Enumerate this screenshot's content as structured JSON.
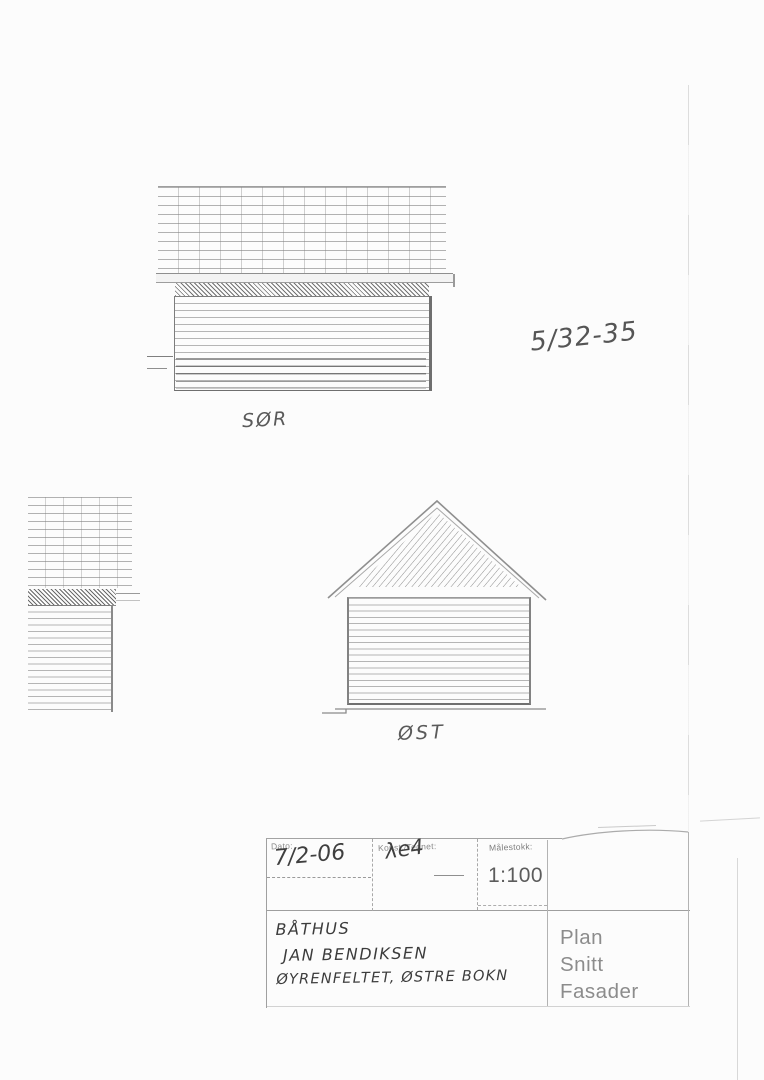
{
  "document": {
    "kind": "scanned architectural elevation drawing",
    "paper_color": "#fcfcfc",
    "line_color": "#9a9a9a",
    "handwriting_color": "#3f3f3f",
    "printed_text_color": "#8c8c8c"
  },
  "annotations": {
    "sheet_number": "5/32-35"
  },
  "drawings": {
    "south": {
      "label": "SØR"
    },
    "east": {
      "label": "ØST"
    },
    "west_partial": {
      "label": ""
    }
  },
  "title_block": {
    "date_label": "Dato:",
    "date_value": "7/2-06",
    "drawn_label": "Konst./Tegnet:",
    "drawn_value": "λe4",
    "scale_label": "Målestokk:",
    "scale_value": "1:100",
    "project_lines": [
      "BÅTHUS",
      "JAN BENDIKSEN",
      "ØYRENFELTET, ØSTRE BOKN"
    ],
    "content_lines": [
      "Plan",
      "Snitt",
      "Fasader"
    ]
  }
}
